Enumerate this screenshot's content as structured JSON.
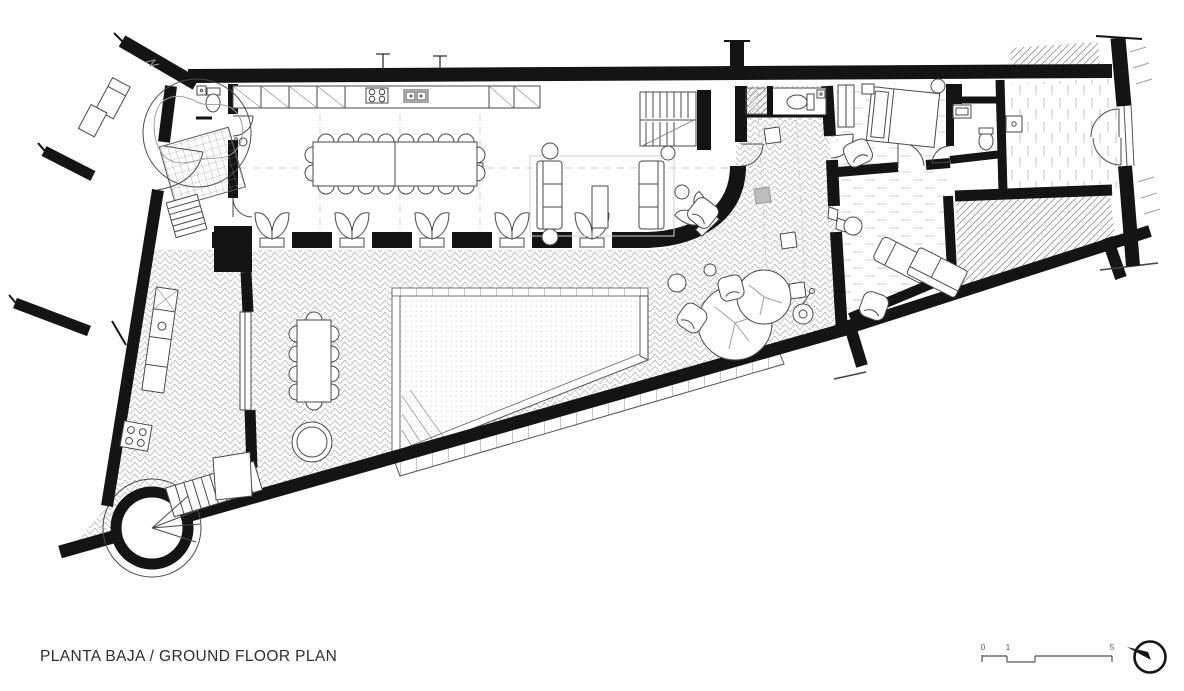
{
  "caption": {
    "text": "PLANTA BAJA / GROUND FLOOR PLAN"
  },
  "scale_bar": {
    "labels": [
      "0",
      "1",
      "5"
    ]
  },
  "colors": {
    "ink": "#141414",
    "line": "#4a4a4a",
    "hatch": "#9f9f9f",
    "light": "#cfcfcf",
    "paper": "#ffffff"
  }
}
